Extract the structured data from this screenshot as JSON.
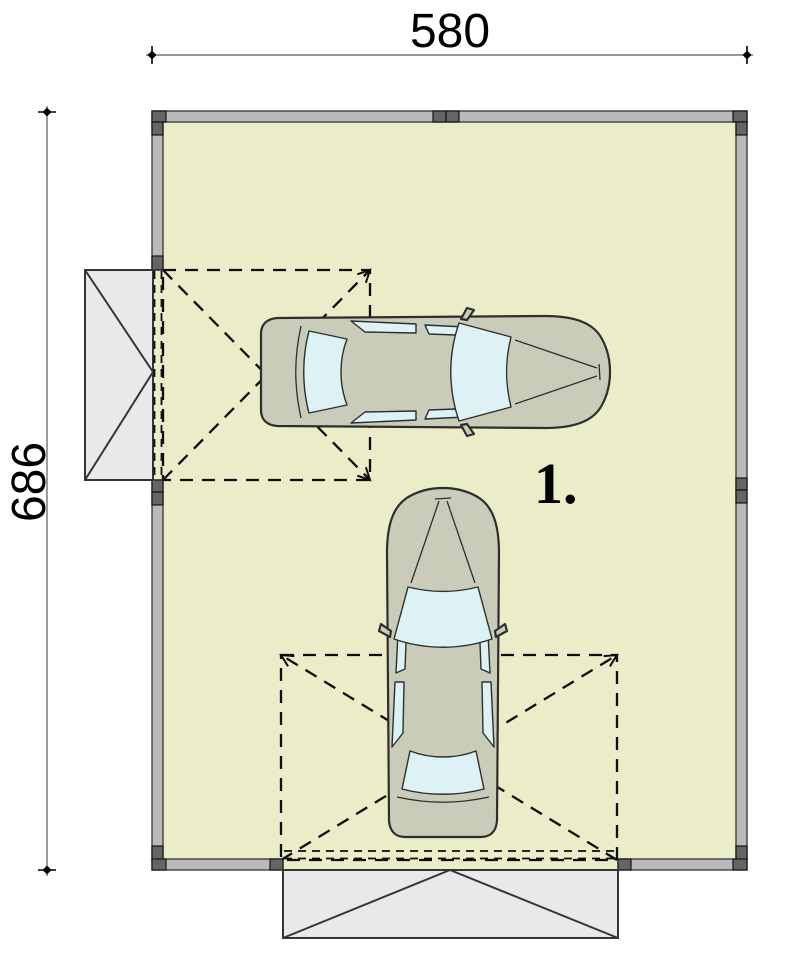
{
  "plan": {
    "title": "garage floor plan",
    "dimensions": {
      "top": {
        "label": "580"
      },
      "left": {
        "label": "686"
      }
    },
    "bay": {
      "label": "1."
    },
    "doors": {
      "left_door": "tilt-up garage door with swing area",
      "bottom_door": "tilt-up garage door with swing area"
    }
  },
  "icons": {
    "car_horizontal": "car-top-view",
    "car_vertical": "car-top-view"
  },
  "colors": {
    "page-bg": "#ffffff",
    "room-fill": "#ebedc8",
    "wall-fill": "#b9bab9",
    "wall-stroke": "#404040",
    "post-fill": "#656565",
    "post-stroke": "#161616",
    "panel-fill": "#e9e9ec",
    "panel-stroke": "#353535",
    "car-body": "#c8ccb8",
    "car-stroke": "#2e2e2e",
    "car-window": "#dcf2f4",
    "dash-stroke": "#0c0c0c",
    "dim-line": "#5a5a5a",
    "dim-text": "#000000"
  }
}
